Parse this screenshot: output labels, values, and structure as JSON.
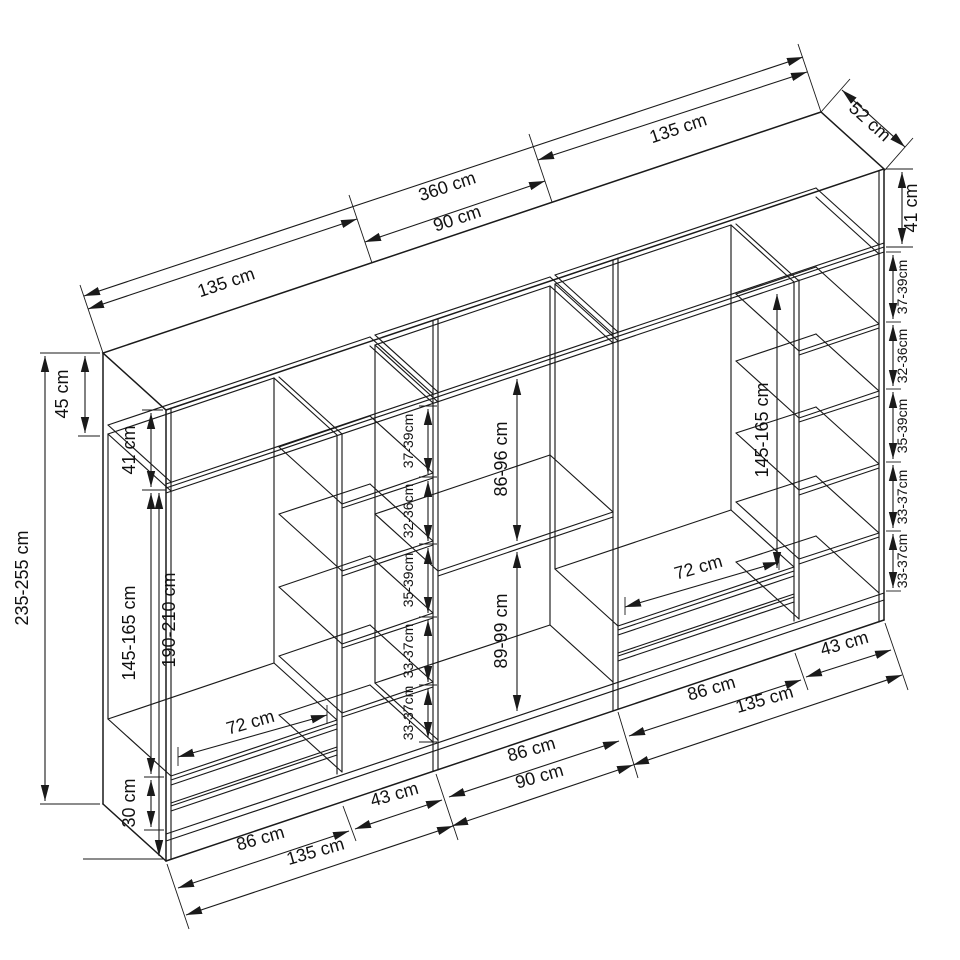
{
  "meta": {
    "type": "isometric furniture dimension diagram",
    "background": "#ffffff",
    "line_color": "#1a1a1a"
  },
  "labels": {
    "top": {
      "a": "135 cm",
      "total": "360 cm",
      "b": "90 cm",
      "c": "135 cm",
      "depth": "52 cm"
    },
    "left": {
      "upper": "45 cm",
      "upper_inner": "41 cm",
      "total": "235-255 cm",
      "body": "190-210 cm",
      "hang": "145-165 cm",
      "base": "30 cm"
    },
    "right": {
      "upper": "41 cm",
      "s1": "37-39cm",
      "s2": "32-36cm",
      "s3": "35-39cm",
      "s4": "33-37cm",
      "s5": "33-37cm"
    },
    "col_a": {
      "s1": "37-39cm",
      "s2": "32-36cm",
      "s3": "35-39cm",
      "s4": "33-37cm",
      "s5": "33-37cm"
    },
    "mid": {
      "upper": "86-96 cm",
      "lower": "89-99 cm"
    },
    "hang_c": "145-165 cm",
    "bottom_a": {
      "rod": "72 cm",
      "inner": "86 cm",
      "col": "43 cm",
      "total": "135 cm"
    },
    "bottom_b": {
      "inner": "86 cm",
      "total": "90 cm"
    },
    "bottom_c": {
      "rod": "72 cm",
      "inner": "86 cm",
      "col": "43 cm",
      "total": "135 cm"
    }
  }
}
